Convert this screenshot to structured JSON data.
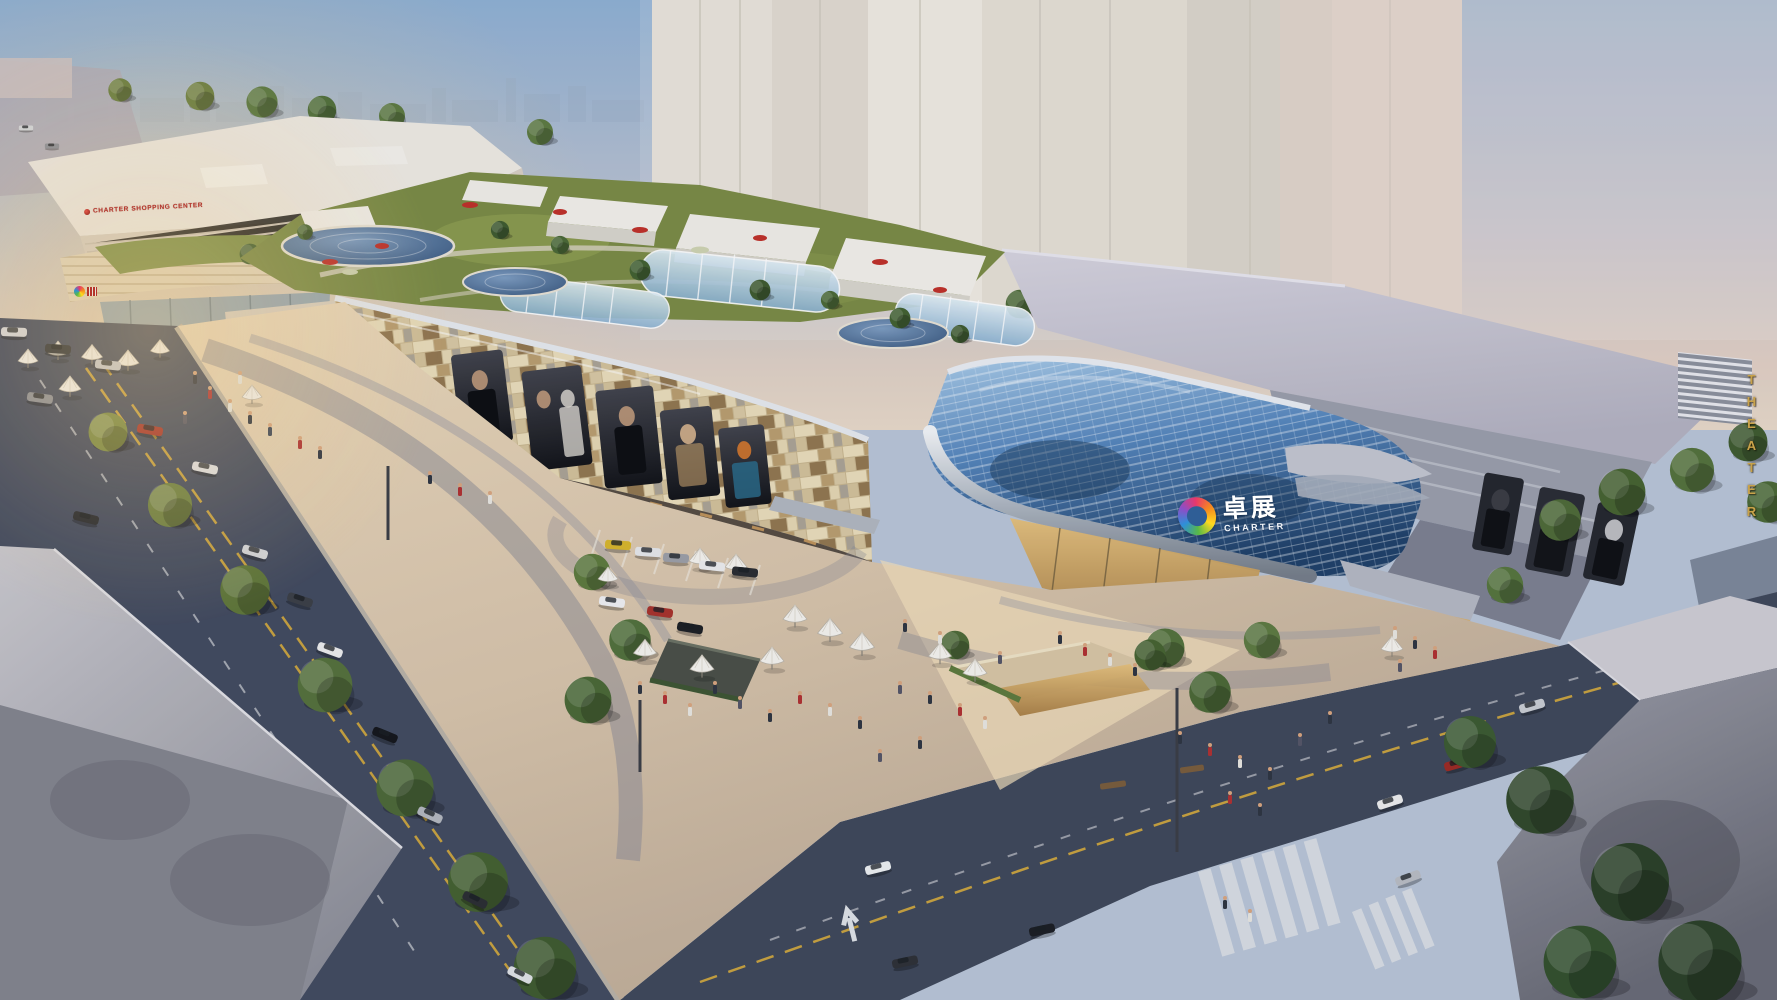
{
  "scene": {
    "description": "Aerial dusk rendering of the Charter shopping mall complex: long mosaic-panel mall with roof gardens and glass skylights, blue glass atrium entrance, theater wing, surrounding streets with traffic, and a public plaza with cafe umbrellas",
    "time_of_day": "dusk"
  },
  "signs": {
    "annex_rooftop_sign": "CHARTER SHOPPING CENTER",
    "theater_vertical_sign": "THEATER"
  },
  "logo": {
    "name": "charter-knot-logo",
    "chinese": "卓展",
    "latin": "CHARTER",
    "ring_colors": [
      "#e8376b",
      "#f58a1f",
      "#ffd91f",
      "#58b947",
      "#2e8fd8",
      "#8a4fc8"
    ]
  },
  "palette": {
    "sky_top": "#8fb0d2",
    "sky_haze": "#e3d2c6",
    "background_towers": "#e7e0d4",
    "mall_panels": "#d4c19c",
    "atrium_glass": "#3f6ea6",
    "roof_garden_green": "#7b8b44",
    "asphalt": "#424a5e",
    "plaza_paving": "#dcc9ae",
    "foreground_buildings": "#8e8f99",
    "sign_red": "#b5342a",
    "sign_gold": "#c8a24a"
  }
}
